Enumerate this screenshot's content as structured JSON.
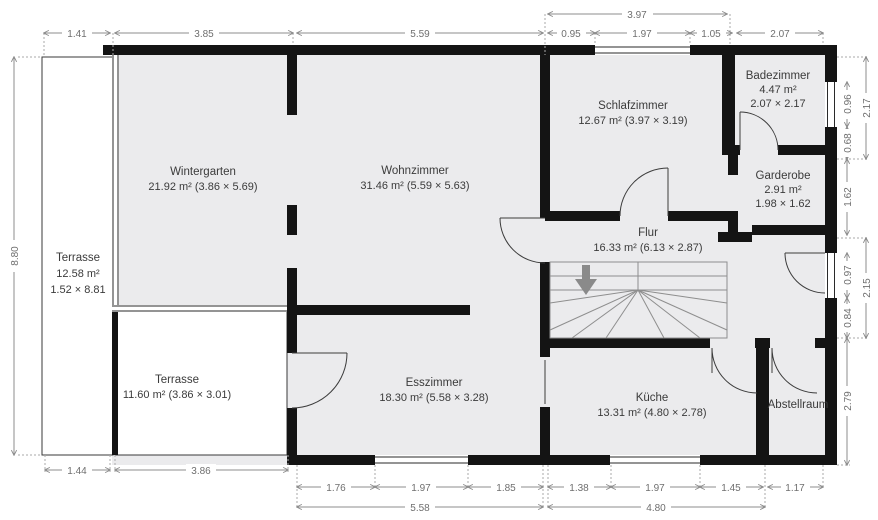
{
  "rooms": {
    "wintergarten": {
      "name": "Wintergarten",
      "area_line": "21.92 m² (3.86 × 5.69)"
    },
    "wohnzimmer": {
      "name": "Wohnzimmer",
      "area_line": "31.46 m² (5.59 × 5.63)"
    },
    "schlafzimmer": {
      "name": "Schlafzimmer",
      "area_line": "12.67 m² (3.97 × 3.19)"
    },
    "badezimmer": {
      "name": "Badezimmer",
      "area_line": "4.47 m²",
      "size_line": "2.07 × 2.17"
    },
    "garderobe": {
      "name": "Garderobe",
      "area_line": "2.91 m²",
      "size_line": "1.98 × 1.62"
    },
    "flur": {
      "name": "Flur",
      "area_line": "16.33 m² (6.13 × 2.87)"
    },
    "terrasse_west": {
      "name": "Terrasse",
      "area_line": "12.58 m²",
      "size_line": "1.52 × 8.81"
    },
    "terrasse_sued": {
      "name": "Terrasse",
      "area_line": "11.60 m² (3.86 × 3.01)"
    },
    "esszimmer": {
      "name": "Esszimmer",
      "area_line": "18.30 m² (5.58 × 3.28)"
    },
    "kueche": {
      "name": "Küche",
      "area_line": "13.31 m² (4.80 × 2.78)"
    },
    "abstellraum": {
      "name": "Abstellraum"
    }
  },
  "dimensions": {
    "top_total": "3.97",
    "top": [
      "1.41",
      "3.85",
      "5.59",
      "0.95",
      "1.97",
      "1.05",
      "2.07"
    ],
    "left": "8.80",
    "right": [
      "0.96",
      "0.68",
      "2.17",
      "1.62",
      "0.97",
      "0.84",
      "2.15",
      "2.79"
    ],
    "bottom": [
      "1.44",
      "3.86",
      "1.76",
      "1.97",
      "1.85",
      "1.38",
      "1.97",
      "1.45",
      "1.17"
    ],
    "bottom_totals": [
      "5.58",
      "4.80"
    ]
  },
  "colors": {
    "wall": "#141414",
    "room_fill": "#ebebed",
    "terrace_fill": "#ffffff",
    "dimension": "#8c8c8c",
    "label_text": "#3b3b3b",
    "stair_arrow": "#8a8a8a"
  }
}
